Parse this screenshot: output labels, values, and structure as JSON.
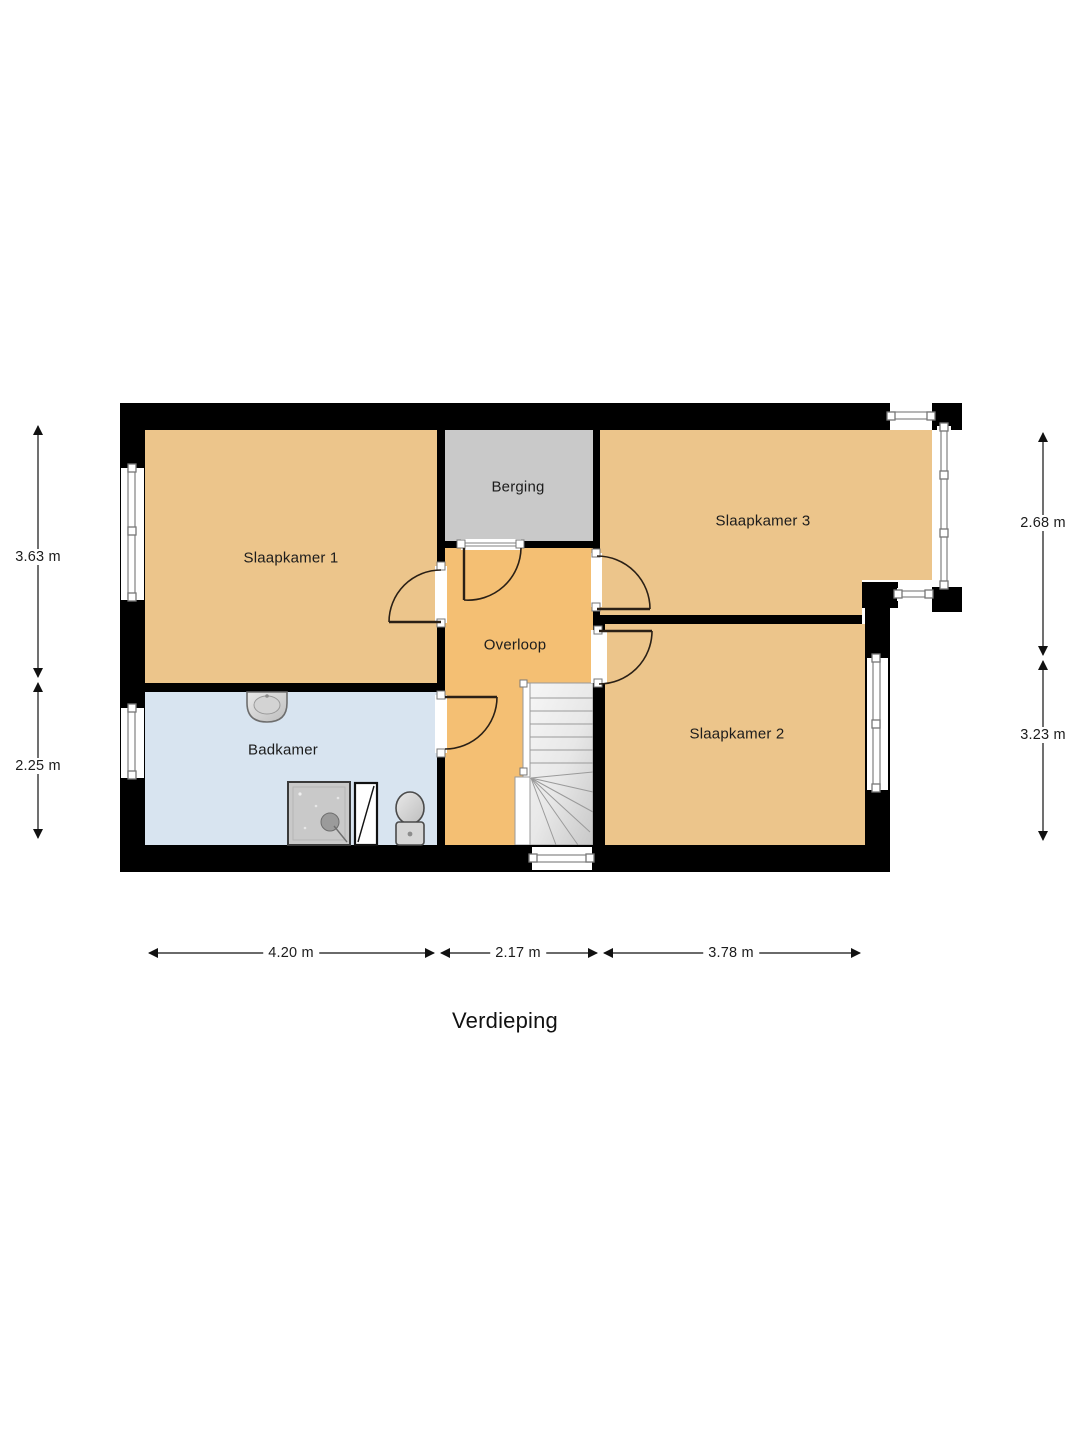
{
  "plan": {
    "title": "Verdieping",
    "rooms": {
      "slaapkamer1": {
        "label": "Slaapkamer 1",
        "color": "#ECC58B"
      },
      "berging": {
        "label": "Berging",
        "color": "#C9C9C9"
      },
      "slaapkamer3": {
        "label": "Slaapkamer 3",
        "color": "#ECC58B"
      },
      "overloop": {
        "label": "Overloop",
        "color": "#F4BF73"
      },
      "slaapkamer2": {
        "label": "Slaapkamer 2",
        "color": "#ECC58B"
      },
      "badkamer": {
        "label": "Badkamer",
        "color": "#D8E4F0"
      }
    },
    "dimensions": {
      "left_top": "3.63 m",
      "left_bottom": "2.25 m",
      "right_top": "2.68 m",
      "right_bottom": "3.23 m",
      "bottom_left": "4.20 m",
      "bottom_middle": "2.17 m",
      "bottom_right": "3.78 m"
    },
    "colors": {
      "wall": "#000000",
      "window_frame": "#8A8A8A",
      "door_line": "#2A2016",
      "stairs_light": "#F4F4F4",
      "stairs_dark": "#CDCDCD",
      "background": "#FFFFFF"
    },
    "fixtures": {
      "sink": "sink",
      "shower": "shower-tray",
      "shower_screen": "shower-screen",
      "toilet": "toilet",
      "staircase": "winder-staircase"
    }
  }
}
